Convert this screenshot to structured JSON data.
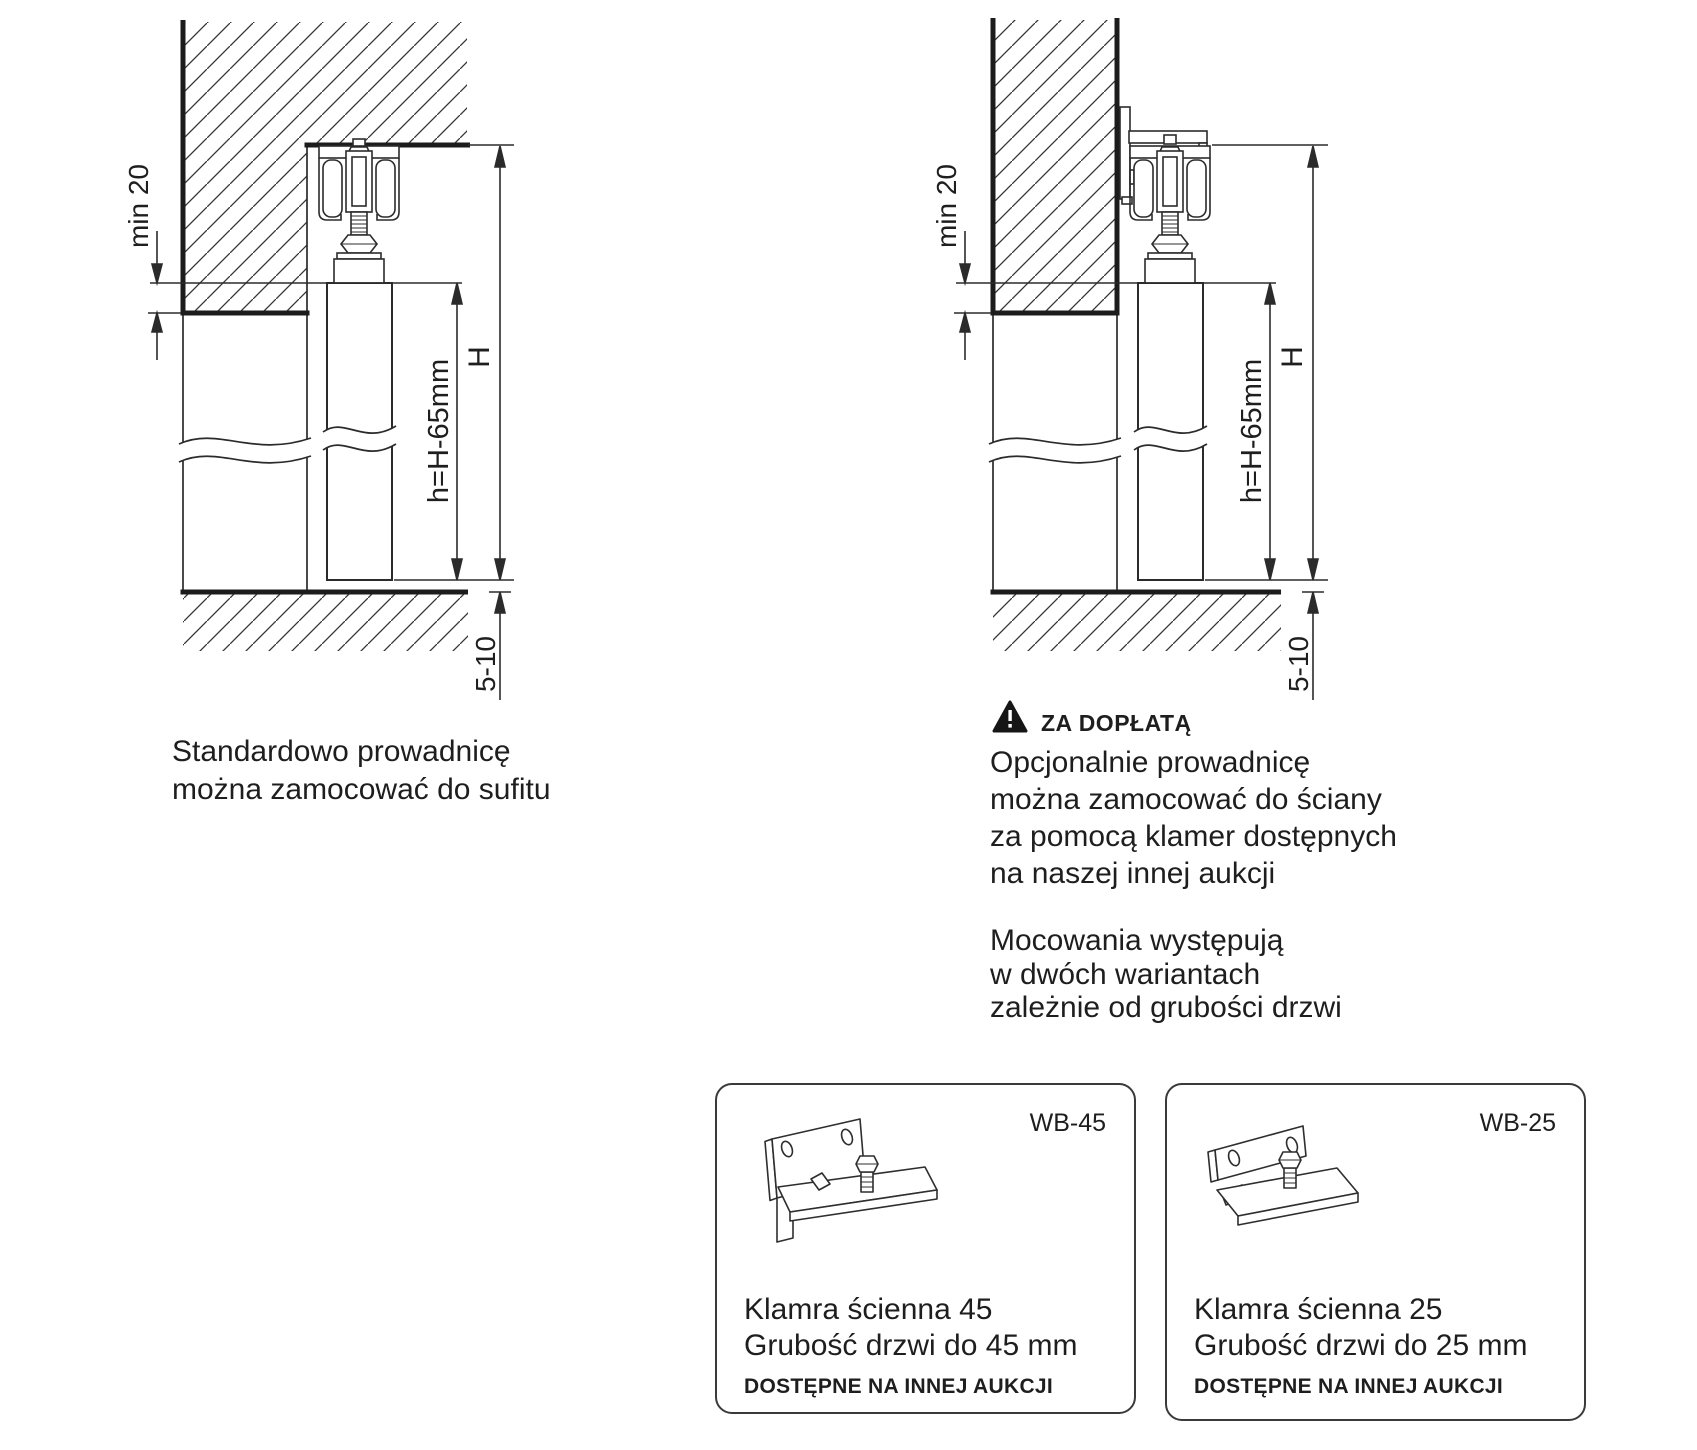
{
  "colors": {
    "line": "#2b2b2b",
    "thick_line": "#1c1c1c",
    "text": "#1e1e1e"
  },
  "dimensions": {
    "min20": "min 20",
    "H": "H",
    "h": "h=H-65mm",
    "gap": "5-10"
  },
  "left_caption": {
    "line1": "Standardowo prowadnicę",
    "line2": "można zamocować do sufitu"
  },
  "right_note": {
    "icon": "warning-triangle-icon",
    "badge": "ZA DOPŁATĄ",
    "line1": "Opcjonalnie prowadnicę",
    "line2": "można zamocować do ściany",
    "line3": "za pomocą klamer dostępnych",
    "line4": "na naszej innej aukcji"
  },
  "variants_note": {
    "line1": "Mocowania występują",
    "line2": "w dwóch wariantach",
    "line3": "zależnie od grubości drzwi"
  },
  "cards": [
    {
      "code": "WB-45",
      "title": "Klamra ścienna 45",
      "subtitle": "Grubość drzwi do 45 mm",
      "footnote": "DOSTĘPNE NA INNEJ AUKCJI"
    },
    {
      "code": "WB-25",
      "title": "Klamra ścienna 25",
      "subtitle": "Grubość drzwi do 25 mm",
      "footnote": "DOSTĘPNE NA INNEJ AUKCJI"
    }
  ]
}
